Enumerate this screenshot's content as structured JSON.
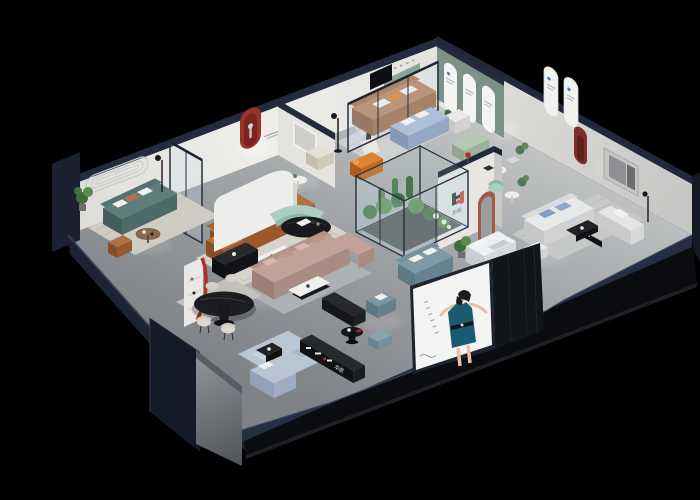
{
  "scene": {
    "title": "3D isometric furniture showroom cutaway render",
    "background": "#000000"
  },
  "brand": {
    "name": "华凯",
    "monogram": "H",
    "colors": {
      "red": "#cf2a1e",
      "black": "#17171a",
      "blue": "#2f7fc2"
    }
  },
  "poster": {
    "panel_color": "#f4f4f2",
    "dress_color": "#1a5a72",
    "subject": "fashion model in teal dress"
  },
  "palette": {
    "floor": "#9b9ea1",
    "wall": "#e9e8e5",
    "wall_cap_navy": "#242b3d",
    "facade_dark": "#0a0c0f",
    "facade_silver": "#888c91",
    "green_accent_wall": "#7c9187",
    "red_arch_niche": "#993229",
    "terracotta_arch": "#a65847"
  },
  "furniture_colors": {
    "teal_sofa": "#5f7d7b",
    "caramel_sofa": "#b4713f",
    "tan_sofa": "#b3805c",
    "mauve_sofa": "#c2a198",
    "light_blue_sofa": "#aebfd8",
    "blue_grey_sofa": "#7f99a6",
    "white_sofa": "#e7e8e8",
    "mint_accent": "#a9cfc1",
    "yellow_pillow": "#f0a51e",
    "orange_chaise": "#e0832e"
  },
  "rooms": [
    {
      "name": "teal-sofa-lounge"
    },
    {
      "name": "caramel-sofa-lounge"
    },
    {
      "name": "tan-sofa-lounge"
    },
    {
      "name": "glass-blue-sofa-zone"
    },
    {
      "name": "center-mauve-lounge"
    },
    {
      "name": "glass-garden-atrium"
    },
    {
      "name": "dining-area"
    },
    {
      "name": "front-blue-room"
    },
    {
      "name": "white-sofa-room"
    },
    {
      "name": "blue-grey-lounge"
    }
  ]
}
